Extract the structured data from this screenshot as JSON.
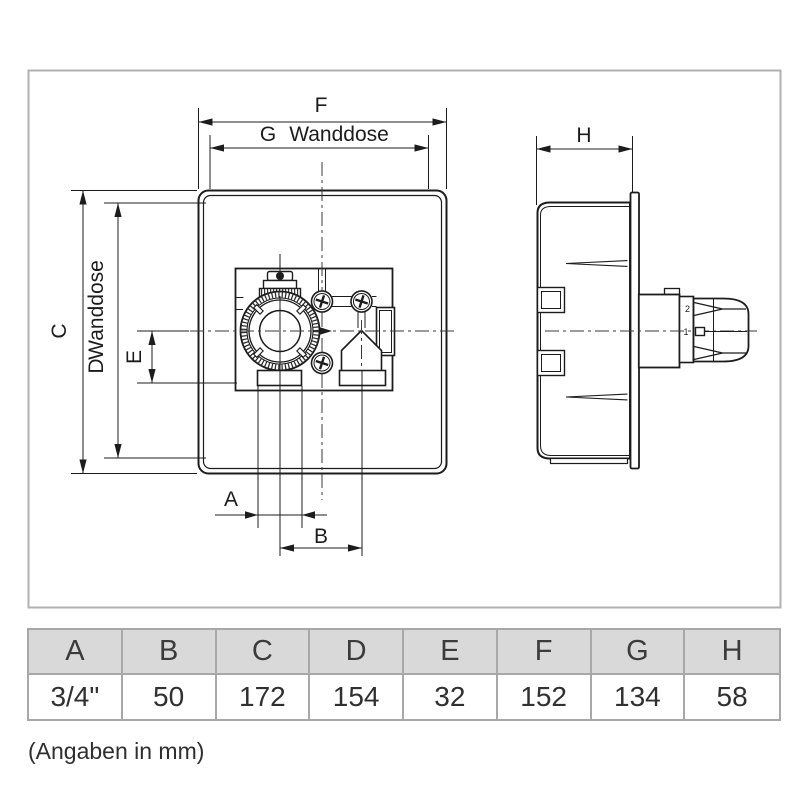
{
  "drawing": {
    "front_view": {
      "dim_a_label": "A",
      "dim_b_label": "B",
      "dim_c_label": "C",
      "dim_d_letter": "D",
      "dim_d_word": "Wanddose",
      "dim_e_label": "E",
      "dim_f_label": "F",
      "dim_g_letter": "G",
      "dim_g_word": "Wanddose"
    },
    "side_view": {
      "dim_h_label": "H",
      "valve_mark_top": "2",
      "valve_mark_bottom": "1"
    },
    "colors": {
      "line": "#1c1c1c",
      "frame_border": "#b1b1b1",
      "table_border": "#a8a8a8",
      "table_header_bg": "#d9d9d9",
      "table_text": "#3b3b3b"
    }
  },
  "table": {
    "headers": [
      "A",
      "B",
      "C",
      "D",
      "E",
      "F",
      "G",
      "H"
    ],
    "values": [
      "3/4\"",
      "50",
      "172",
      "154",
      "32",
      "152",
      "134",
      "58"
    ]
  },
  "footnote": "(Angaben in mm)"
}
